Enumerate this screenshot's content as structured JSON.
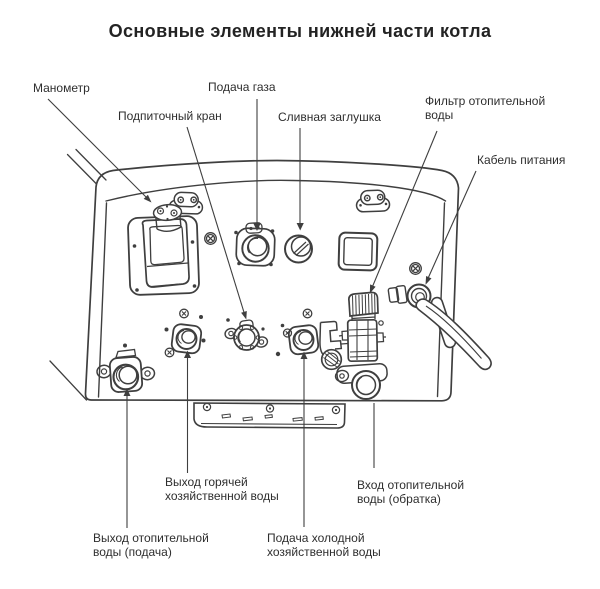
{
  "title": "Основные элементы нижней части котла",
  "colors": {
    "ink": "#3f3f3f",
    "text": "#2e2e2e",
    "background": "#ffffff"
  },
  "callouts": {
    "manometer": {
      "lines": [
        "Манометр"
      ]
    },
    "gas_supply": {
      "lines": [
        "Подача газа"
      ]
    },
    "makeup_valve": {
      "lines": [
        "Подпиточный кран"
      ]
    },
    "drain_plug": {
      "lines": [
        "Сливная заглушка"
      ]
    },
    "heating_water_filter": {
      "lines": [
        "Фильтр отопительной",
        "воды"
      ]
    },
    "power_cable": {
      "lines": [
        "Кабель питания"
      ]
    },
    "hot_dhw_outlet": {
      "lines": [
        "Выход горячей",
        "хозяйственной воды"
      ]
    },
    "heating_return_inlet": {
      "lines": [
        "Вход отопительной",
        "воды (обратка)"
      ]
    },
    "heating_supply_outlet": {
      "lines": [
        "Выход отопительной",
        "воды (подача)"
      ]
    },
    "cold_dhw_inlet": {
      "lines": [
        "Подача холодной",
        "хозяйственной воды"
      ]
    }
  }
}
